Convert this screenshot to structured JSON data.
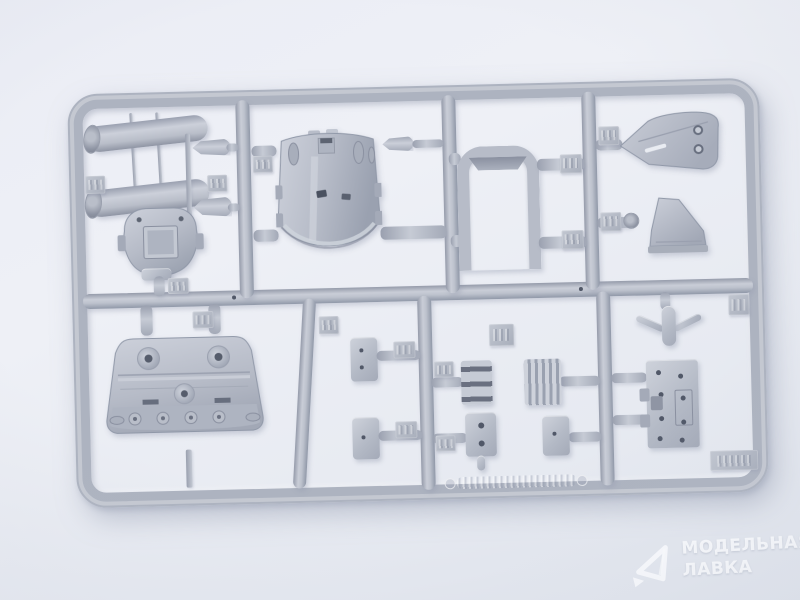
{
  "scene": {
    "type": "product-photo",
    "subject": "Gray injection-molded plastic model kit sprue (runner frame with attached parts) on a light studio background",
    "background_color": "#e9ebf3",
    "plastic_color": "#b6bbc7",
    "plastic_highlight": "#d3d7e0",
    "plastic_shadow": "#9098a8"
  },
  "watermark": {
    "logo": "paper-plane-logo",
    "line1": "МОДЕЛЬНАЯ",
    "line2": "ЛАВКА",
    "text_color": "#fcfdff"
  },
  "sprue": {
    "frame_shape": "rounded rectangle",
    "embossed_marking": "illegible molded lettering on bottom rail",
    "number_tags_count": 17,
    "parts": [
      {
        "id": "pipe-upper",
        "desc": "angled cylindrical pipe"
      },
      {
        "id": "pipe-lower",
        "desc": "angled cylindrical pipe"
      },
      {
        "id": "thin-rods",
        "desc": "two thin connecting rods"
      },
      {
        "id": "strut-bar",
        "desc": "thin vertical strut"
      },
      {
        "id": "torpedo-upper",
        "desc": "small teardrop-shaped part"
      },
      {
        "id": "torpedo-lower",
        "desc": "small teardrop-shaped part"
      },
      {
        "id": "dome-cowling",
        "desc": "round dome with raised center box"
      },
      {
        "id": "curved-shell",
        "desc": "large curved shell with oval openings"
      },
      {
        "id": "u-channel",
        "desc": "open-bottom rectangular channel"
      },
      {
        "id": "shield-bulkhead",
        "desc": "left-pointing shield with two holes"
      },
      {
        "id": "funnel-chute",
        "desc": "trapezoidal funnel"
      },
      {
        "id": "hull-bulkhead",
        "desc": "wide hull section with bosses and portholes"
      },
      {
        "id": "bullet-fitting",
        "desc": "small bullet-shaped fitting"
      },
      {
        "id": "cleat",
        "desc": "bollard with curved arms"
      },
      {
        "id": "riveted-plate",
        "desc": "rectangular plate with rivet holes and tabs"
      },
      {
        "id": "box-a",
        "desc": "small rectangular block"
      },
      {
        "id": "box-b",
        "desc": "small rectangular block"
      },
      {
        "id": "slotted-bracket",
        "desc": "block with three slots"
      },
      {
        "id": "ribbed-box",
        "desc": "block with vertical ribs"
      },
      {
        "id": "plate-two-holes",
        "desc": "flat plate with two holes and stub"
      },
      {
        "id": "box-c",
        "desc": "small rectangular block"
      }
    ]
  }
}
